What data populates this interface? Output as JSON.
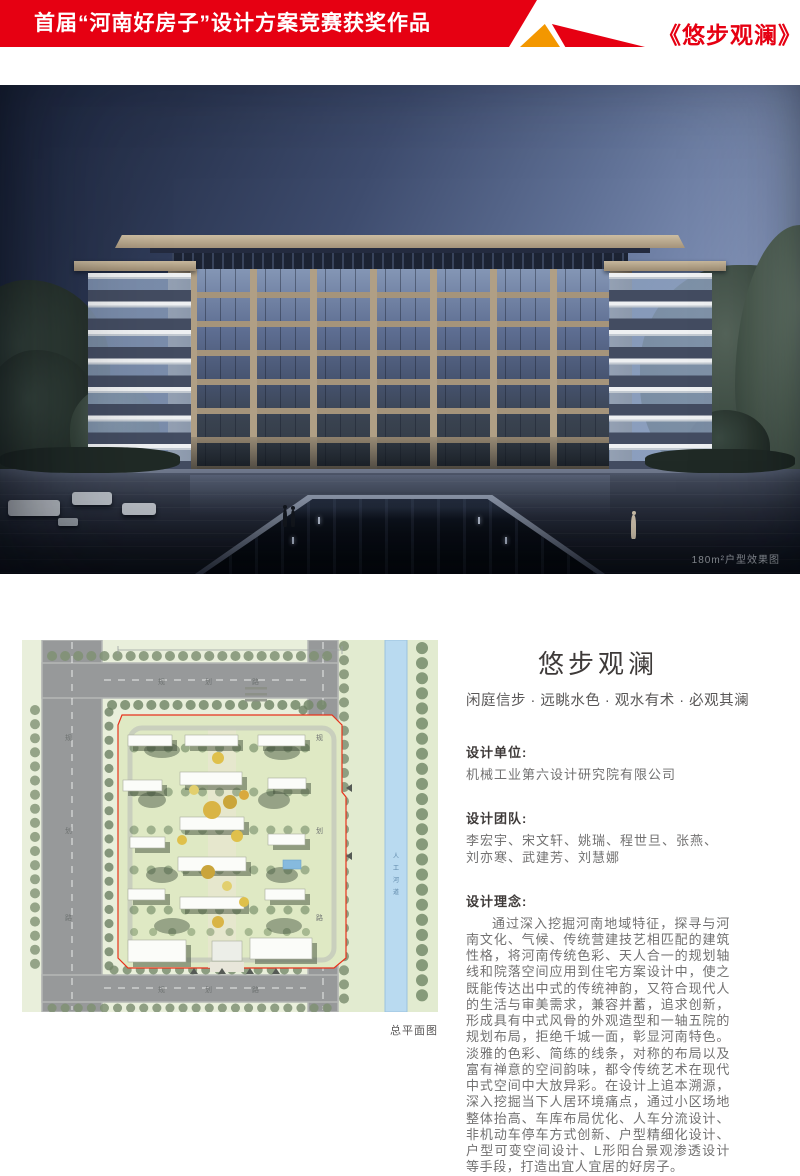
{
  "header": {
    "banner_title": "首届“河南好房子”设计方案竞赛获奖作品",
    "project_title": "《悠步观澜》",
    "colors": {
      "red": "#e60012",
      "orange": "#f39700"
    }
  },
  "render": {
    "caption": "180m²户型效果图"
  },
  "plan": {
    "road_labels": [
      "规",
      "划",
      "路"
    ],
    "river_label_chars": [
      "人",
      "工",
      "河",
      "道"
    ],
    "caption": "总平面图"
  },
  "info": {
    "title": "悠步观澜",
    "subtitle": "闲庭信步 · 远眺水色 · 观水有术 · 必观其澜",
    "unit_label": "设计单位:",
    "unit_value": "机械工业第六设计研究院有限公司",
    "team_label": "设计团队:",
    "team_value": "李宏宇、宋文轩、姚瑞、程世旦、张燕、刘亦寒、武建芳、刘慧娜",
    "concept_label": "设计理念:",
    "concept_text": "通过深入挖掘河南地域特征，探寻与河南文化、气候、传统营建技艺相匹配的建筑性格，将河南传统色彩、天人合一的规划轴线和院落空间应用到住宅方案设计中，使之既能传达出中式的传统神韵，又符合现代人的生活与审美需求，兼容并蓄，追求创新，形成具有中式风骨的外观造型和一轴五院的规划布局，拒绝千城一面，彰显河南特色。淡雅的色彩、简练的线条，对称的布局以及富有禅意的空间韵味，都令传统艺术在现代中式空间中大放异彩。在设计上追本溯源，深入挖掘当下人居环境痛点，通过小区场地整体抬高、车库布局优化、人车分流设计、非机动车停车方式创新、户型精细化设计、户型可变空间设计、L形阳台景观渗透设计等手段，打造出宜人宜居的好房子。"
  }
}
